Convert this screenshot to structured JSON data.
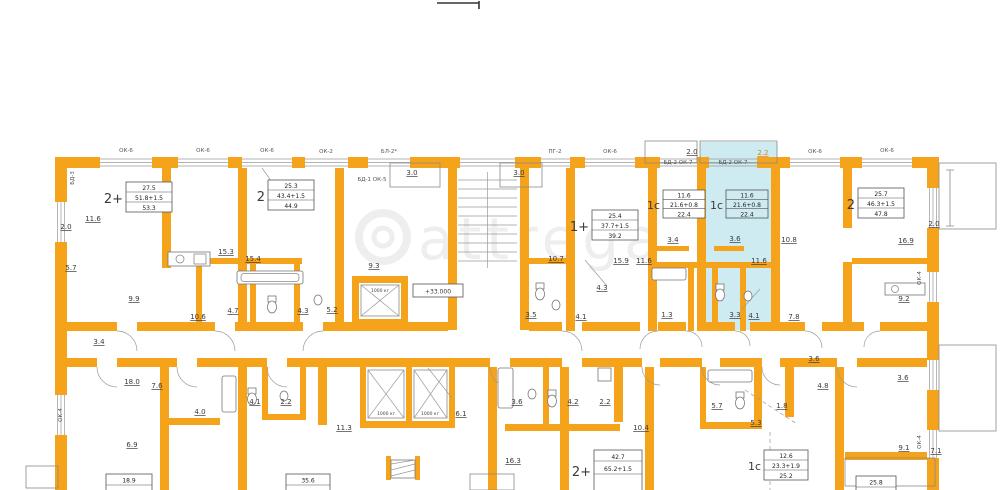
{
  "watermark": {
    "text": "attrega"
  },
  "colors": {
    "wall": "#F5A31B",
    "highlight": "#CEEBF2",
    "line": "#8a8a8a",
    "accent_label": "#D9822B"
  },
  "stamps": [
    {
      "prefix": "2+",
      "rows": [
        "27.5",
        "51.8+1.5",
        "53.3"
      ]
    },
    {
      "prefix": "2",
      "rows": [
        "25.3",
        "43.4+1.5",
        "44.9"
      ]
    },
    {
      "prefix": "1+",
      "rows": [
        "25.4",
        "37.7+1.5",
        "39.2"
      ]
    },
    {
      "prefix": "1с",
      "rows": [
        "11.6",
        "21.6+0.8",
        "22.4"
      ]
    },
    {
      "prefix": "1с",
      "rows": [
        "11.6",
        "21.6+0.8",
        "22.4"
      ]
    },
    {
      "prefix": "2",
      "rows": [
        "25.7",
        "46.3+1.5",
        "47.8"
      ]
    },
    {
      "prefix": "2+",
      "rows": [
        "42.7",
        "65.2+1.5"
      ]
    },
    {
      "prefix": "1с",
      "rows": [
        "12.6",
        "23.3+1.9",
        "25.2"
      ]
    },
    {
      "prefix": "",
      "rows": [
        "18.9"
      ]
    },
    {
      "prefix": "",
      "rows": [
        "35.6"
      ]
    },
    {
      "prefix": "",
      "rows": [
        "25.8"
      ]
    }
  ],
  "room_areas": {
    "upper_left": [
      "11.6",
      "2.0",
      "5.7",
      "15.3",
      "15.4",
      "9.9",
      "10.6",
      "4.7",
      "4.3",
      "5.2",
      "3.4"
    ],
    "center": [
      "9.3",
      "10.7",
      "15.9",
      "11.6",
      "3.5",
      "4.1",
      "4.3"
    ],
    "upper_right": [
      "3.4",
      "3.6",
      "11.6",
      "10.8",
      "16.9",
      "1.3",
      "3.3",
      "4.1",
      "7.8",
      "9.2"
    ],
    "lower_left": [
      "18.0",
      "7.6",
      "4.0",
      "4.1",
      "2.2",
      "6.9",
      "11.3"
    ],
    "lower_center": [
      "6.1",
      "3.6",
      "4.2",
      "2.2",
      "16.3",
      "10.4"
    ],
    "lower_right": [
      "3.6",
      "4.8",
      "3.6",
      "5.7",
      "1.8",
      "5.3",
      "9.1",
      "7.1"
    ],
    "balconies": [
      "3.0",
      "3.0",
      "2.0",
      "2.2",
      "2.0"
    ]
  },
  "window_marks": {
    "top": [
      "ОК-6",
      "ОК-6",
      "ОК-6",
      "ОК-2",
      "БЛ-2*",
      "ПГ-2",
      "ОК-6",
      "БД-2 ОК-7",
      "БД-2 ОК-7",
      "ОК-6",
      "ОК-6"
    ],
    "door": "БД-1 ОК-5",
    "left_door": "БД-3",
    "left_window": "ОК-4",
    "right_window_1": "ОК-4",
    "right_window_2": "ОК-4"
  },
  "core": {
    "elevation": "+33.000",
    "lift1": "1000 кг",
    "lift2": "1000 кг",
    "lift3": "1000 кг"
  }
}
